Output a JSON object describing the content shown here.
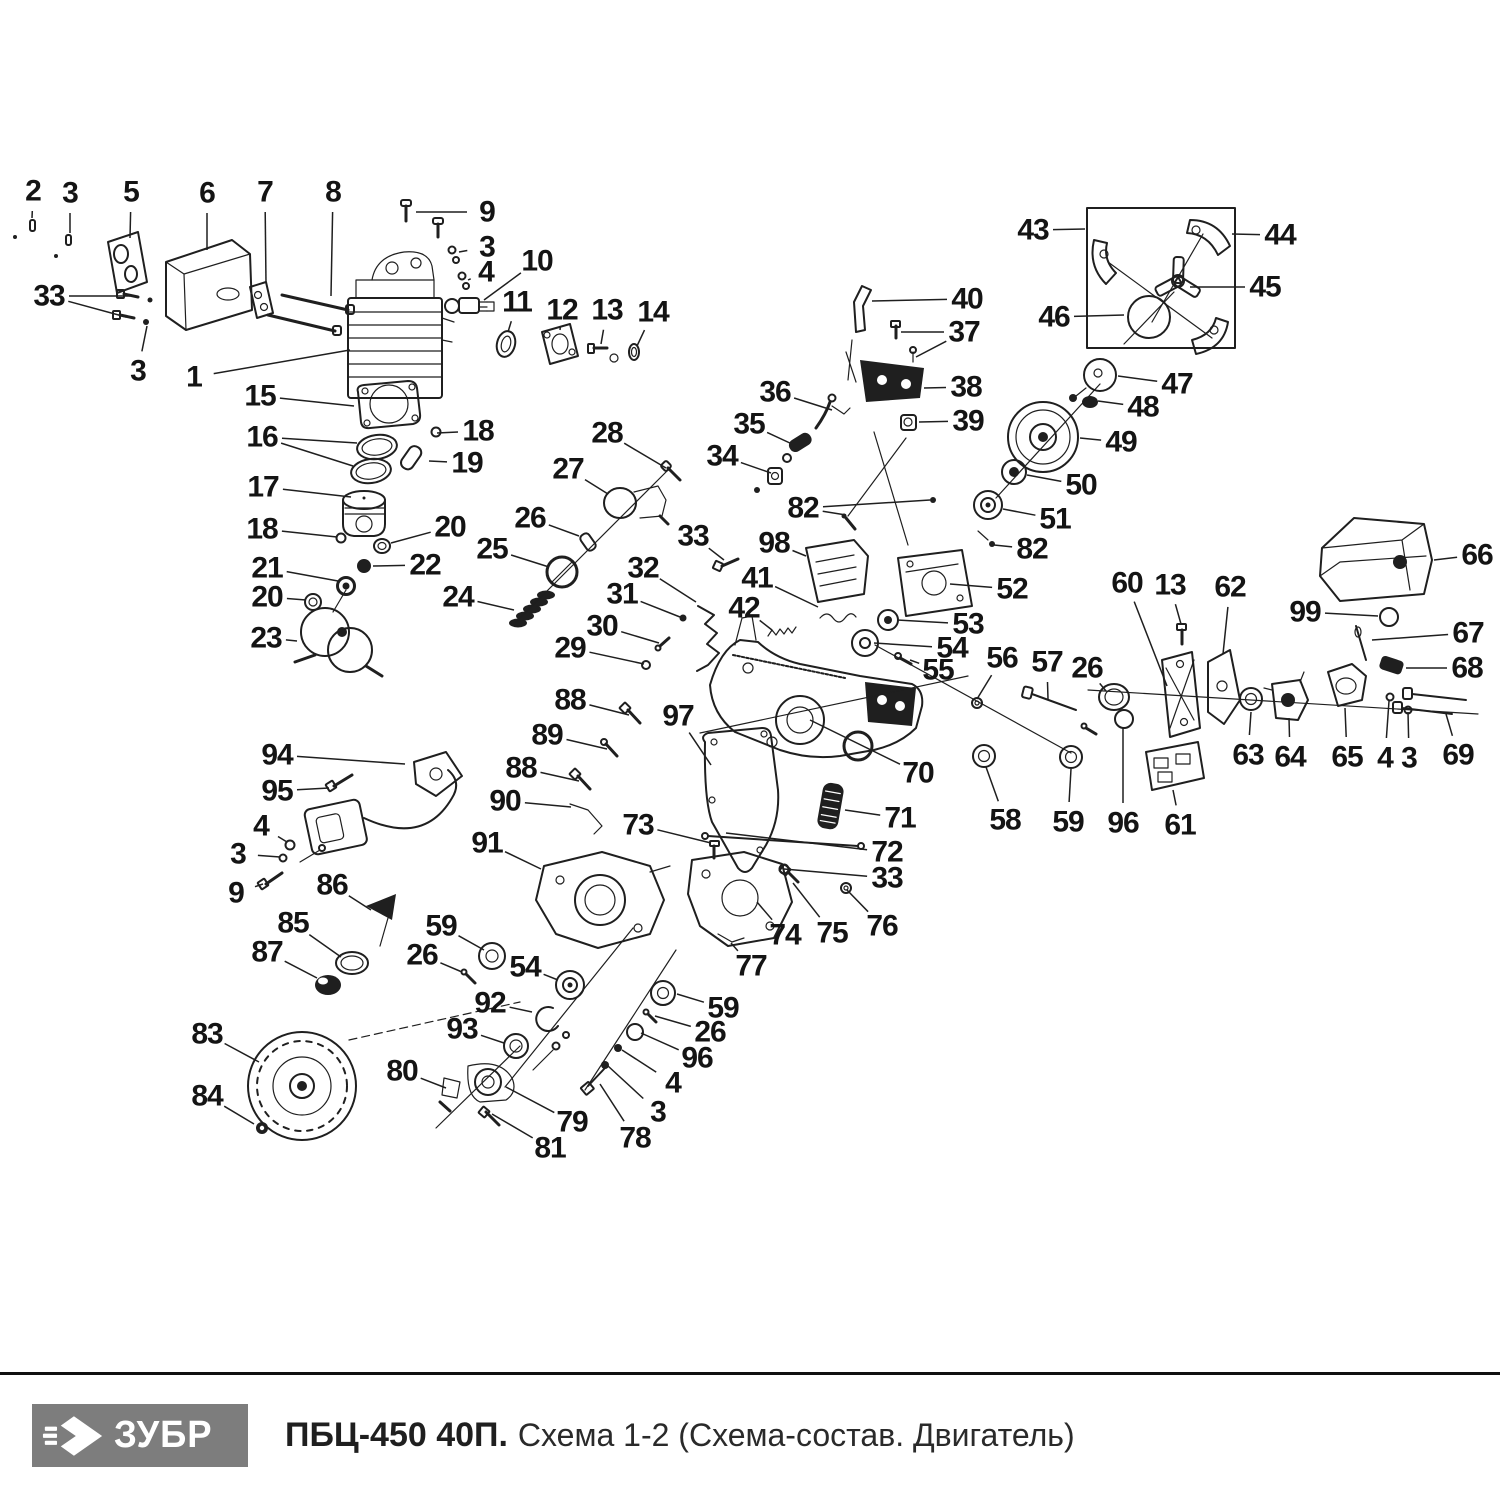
{
  "footer": {
    "brand": "ЗУБР",
    "model": "ПБЦ-450 40П.",
    "subtitle": "Схема 1-2 (Схема-состав. Двигатель)",
    "brand_bg": "#7d7d7d",
    "brand_fg": "#ffffff",
    "rule_color": "#101010"
  },
  "diagram": {
    "ink": "#1f1f1f",
    "note": "callout format [number, label-x, label-y, target-x, target-y, optional-second-target]",
    "callouts": [
      [
        "2",
        33,
        191,
        32,
        218
      ],
      [
        "3",
        70,
        193,
        70,
        233
      ],
      [
        "5",
        131,
        192,
        130,
        238
      ],
      [
        "6",
        207,
        193,
        207,
        250
      ],
      [
        "7",
        265,
        192,
        266,
        283
      ],
      [
        "8",
        333,
        192,
        331,
        296
      ],
      [
        "9",
        487,
        212,
        416,
        212
      ],
      [
        "3",
        487,
        247,
        459,
        252
      ],
      [
        "4",
        486,
        272,
        468,
        280
      ],
      [
        "10",
        537,
        261,
        484,
        300
      ],
      [
        "11",
        517,
        302,
        508,
        332
      ],
      [
        "12",
        562,
        310,
        560,
        330
      ],
      [
        "13",
        607,
        310,
        601,
        344
      ],
      [
        "14",
        653,
        312,
        637,
        346
      ],
      [
        "33",
        49,
        296,
        130,
        296,
        [
          126,
          317
        ]
      ],
      [
        "3",
        138,
        371,
        147,
        326
      ],
      [
        "1",
        194,
        377,
        350,
        350
      ],
      [
        "15",
        260,
        396,
        354,
        406
      ],
      [
        "16",
        262,
        437,
        357,
        443,
        [
          353,
          466
        ]
      ],
      [
        "18",
        478,
        431,
        437,
        433
      ],
      [
        "19",
        467,
        463,
        429,
        461
      ],
      [
        "17",
        263,
        487,
        351,
        497
      ],
      [
        "18",
        262,
        529,
        337,
        537
      ],
      [
        "20",
        450,
        527,
        391,
        543
      ],
      [
        "21",
        267,
        568,
        338,
        581
      ],
      [
        "22",
        425,
        565,
        373,
        566
      ],
      [
        "20",
        267,
        597,
        306,
        600
      ],
      [
        "23",
        266,
        638,
        297,
        641
      ],
      [
        "24",
        458,
        597,
        514,
        610
      ],
      [
        "25",
        492,
        549,
        549,
        567
      ],
      [
        "26",
        530,
        518,
        579,
        536
      ],
      [
        "27",
        568,
        469,
        608,
        494
      ],
      [
        "28",
        607,
        433,
        666,
        468
      ],
      [
        "29",
        570,
        648,
        644,
        664
      ],
      [
        "30",
        602,
        626,
        659,
        643
      ],
      [
        "31",
        622,
        594,
        680,
        617
      ],
      [
        "32",
        643,
        568,
        696,
        602
      ],
      [
        "33",
        693,
        536,
        724,
        560
      ],
      [
        "34",
        722,
        456,
        771,
        473
      ],
      [
        "35",
        749,
        424,
        792,
        444
      ],
      [
        "36",
        775,
        392,
        832,
        410
      ],
      [
        "40",
        967,
        299,
        872,
        301
      ],
      [
        "37",
        964,
        332,
        901,
        332,
        [
          916,
          357
        ]
      ],
      [
        "38",
        966,
        387,
        924,
        388
      ],
      [
        "39",
        968,
        421,
        919,
        422
      ],
      [
        "43",
        1033,
        230,
        1085,
        229
      ],
      [
        "44",
        1280,
        235,
        1232,
        234
      ],
      [
        "45",
        1265,
        287,
        1190,
        287
      ],
      [
        "46",
        1054,
        317,
        1124,
        315
      ],
      [
        "47",
        1177,
        384,
        1118,
        376
      ],
      [
        "48",
        1143,
        407,
        1098,
        401
      ],
      [
        "49",
        1121,
        442,
        1080,
        438
      ],
      [
        "50",
        1081,
        485,
        1027,
        475
      ],
      [
        "51",
        1055,
        519,
        1003,
        509
      ],
      [
        "82",
        803,
        508,
        846,
        515,
        [
          930,
          500
        ]
      ],
      [
        "98",
        774,
        543,
        806,
        556
      ],
      [
        "82",
        1032,
        549,
        994,
        545
      ],
      [
        "52",
        1012,
        589,
        950,
        584
      ],
      [
        "53",
        968,
        624,
        897,
        620
      ],
      [
        "54",
        952,
        648,
        874,
        643
      ],
      [
        "55",
        938,
        670,
        910,
        660
      ],
      [
        "56",
        1002,
        658,
        977,
        699
      ],
      [
        "57",
        1047,
        662,
        1048,
        699
      ],
      [
        "26",
        1087,
        668,
        1106,
        691
      ],
      [
        "41",
        757,
        578,
        818,
        607
      ],
      [
        "42",
        744,
        608,
        772,
        630
      ],
      [
        "66",
        1477,
        555,
        1434,
        560
      ],
      [
        "99",
        1305,
        612,
        1378,
        616
      ],
      [
        "67",
        1468,
        633,
        1372,
        640
      ],
      [
        "68",
        1467,
        668,
        1406,
        668
      ],
      [
        "60",
        1127,
        583,
        1167,
        686
      ],
      [
        "13",
        1170,
        585,
        1181,
        624
      ],
      [
        "62",
        1230,
        587,
        1223,
        654
      ],
      [
        "63",
        1248,
        755,
        1251,
        712
      ],
      [
        "64",
        1290,
        757,
        1289,
        718
      ],
      [
        "65",
        1347,
        757,
        1345,
        708
      ],
      [
        "4",
        1385,
        758,
        1389,
        701
      ],
      [
        "3",
        1409,
        758,
        1408,
        712
      ],
      [
        "69",
        1458,
        755,
        1446,
        714
      ],
      [
        "96",
        1123,
        823,
        1123,
        728
      ],
      [
        "61",
        1180,
        825,
        1173,
        790
      ],
      [
        "58",
        1005,
        820,
        986,
        767
      ],
      [
        "59",
        1068,
        822,
        1071,
        769
      ],
      [
        "70",
        918,
        773,
        810,
        720
      ],
      [
        "71",
        900,
        818,
        845,
        810
      ],
      [
        "72",
        887,
        852,
        726,
        833
      ],
      [
        "33",
        887,
        878,
        784,
        869
      ],
      [
        "88",
        570,
        700,
        629,
        715
      ],
      [
        "97",
        678,
        716,
        711,
        765
      ],
      [
        "89",
        547,
        735,
        607,
        749
      ],
      [
        "88",
        521,
        768,
        579,
        781
      ],
      [
        "90",
        505,
        801,
        571,
        807
      ],
      [
        "73",
        638,
        825,
        711,
        843
      ],
      [
        "91",
        487,
        843,
        541,
        869
      ],
      [
        "94",
        277,
        755,
        405,
        764
      ],
      [
        "95",
        277,
        791,
        329,
        788
      ],
      [
        "4",
        261,
        826,
        287,
        842
      ],
      [
        "3",
        238,
        854,
        280,
        857
      ],
      [
        "9",
        236,
        893,
        263,
        884
      ],
      [
        "86",
        332,
        885,
        371,
        910
      ],
      [
        "85",
        293,
        923,
        341,
        957
      ],
      [
        "87",
        267,
        952,
        317,
        978
      ],
      [
        "59",
        441,
        926,
        484,
        950
      ],
      [
        "26",
        422,
        955,
        462,
        972
      ],
      [
        "54",
        525,
        967,
        558,
        980
      ],
      [
        "92",
        490,
        1003,
        532,
        1012
      ],
      [
        "93",
        462,
        1029,
        504,
        1043
      ],
      [
        "83",
        207,
        1034,
        259,
        1062
      ],
      [
        "84",
        207,
        1096,
        254,
        1124
      ],
      [
        "80",
        402,
        1071,
        446,
        1088
      ],
      [
        "79",
        572,
        1122,
        506,
        1087
      ],
      [
        "81",
        550,
        1148,
        492,
        1114
      ],
      [
        "78",
        635,
        1138,
        600,
        1084
      ],
      [
        "3",
        658,
        1112,
        608,
        1066
      ],
      [
        "4",
        673,
        1083,
        622,
        1050
      ],
      [
        "96",
        697,
        1058,
        641,
        1033
      ],
      [
        "26",
        710,
        1032,
        655,
        1016
      ],
      [
        "59",
        723,
        1008,
        677,
        994
      ],
      [
        "77",
        751,
        966,
        731,
        943
      ],
      [
        "74",
        785,
        935,
        757,
        902
      ],
      [
        "75",
        832,
        933,
        793,
        883
      ],
      [
        "76",
        882,
        926,
        847,
        890
      ]
    ]
  }
}
